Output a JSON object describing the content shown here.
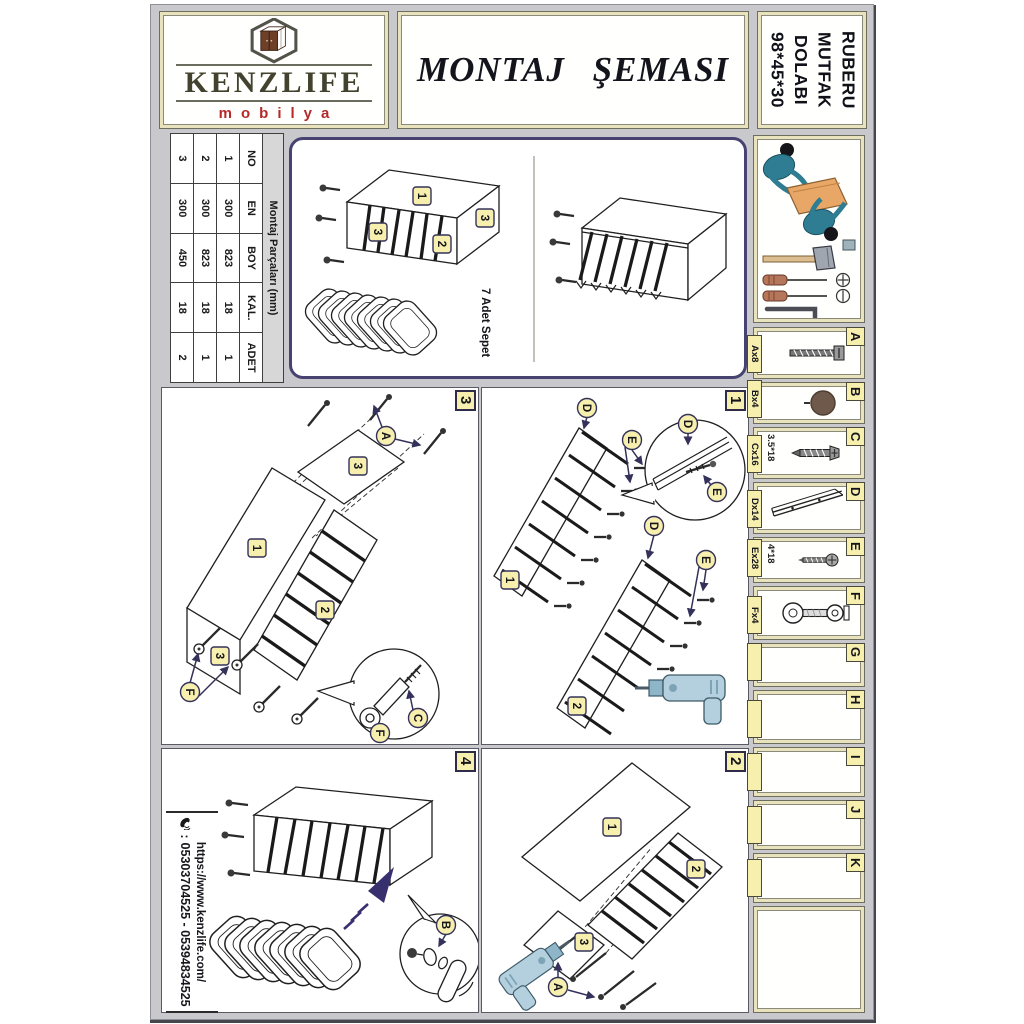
{
  "header": {
    "brand": {
      "name": "KENZLIFE",
      "subtitle": "mobilya",
      "logo_icon": "hexagon-cabinet"
    },
    "title": "MONTAJ ŞEMASI",
    "product": {
      "lines": [
        "RUBERU",
        "MUTFAK",
        "DOLABI",
        "98*45*30"
      ]
    }
  },
  "parts_table": {
    "title": "Montaj Parçaları (mm)",
    "columns": [
      "NO",
      "EN",
      "BOY",
      "KAL.",
      "ADET"
    ],
    "rows": [
      [
        "1",
        "300",
        "823",
        "18",
        "1"
      ],
      [
        "2",
        "300",
        "823",
        "18",
        "1"
      ],
      [
        "3",
        "300",
        "450",
        "18",
        "2"
      ]
    ]
  },
  "overview": {
    "labels": [
      "1",
      "3",
      "2",
      "3"
    ],
    "basket_note": "7 Adet Sepet"
  },
  "hardware": {
    "items": [
      {
        "letter": "A",
        "qty": "Ax8",
        "spec": "",
        "icon": "bolt-screw-icon"
      },
      {
        "letter": "B",
        "qty": "Bx4",
        "spec": "",
        "icon": "cover-cap-icon"
      },
      {
        "letter": "C",
        "qty": "Cx16",
        "spec": "3.5*18",
        "icon": "wood-screw-icon"
      },
      {
        "letter": "D",
        "qty": "Dx14",
        "spec": "",
        "icon": "rail-icon"
      },
      {
        "letter": "E",
        "qty": "Ex28",
        "spec": "4*18",
        "icon": "pan-screw-icon"
      },
      {
        "letter": "F",
        "qty": "Fx4",
        "spec": "",
        "icon": "adjustable-foot-icon"
      },
      {
        "letter": "G",
        "qty": "",
        "spec": "",
        "icon": ""
      },
      {
        "letter": "H",
        "qty": "",
        "spec": "",
        "icon": ""
      },
      {
        "letter": "I",
        "qty": "",
        "spec": "",
        "icon": ""
      },
      {
        "letter": "J",
        "qty": "",
        "spec": "",
        "icon": ""
      },
      {
        "letter": "K",
        "qty": "",
        "spec": "",
        "icon": ""
      }
    ]
  },
  "steps": [
    {
      "number": "1",
      "labels": [
        "D",
        "E",
        "1",
        "D",
        "E",
        "2",
        "D",
        "E"
      ]
    },
    {
      "number": "2",
      "labels": [
        "1",
        "2",
        "3",
        "A"
      ]
    },
    {
      "number": "3",
      "labels": [
        "A",
        "3",
        "1",
        "2",
        "3",
        "F",
        "C",
        "F"
      ]
    },
    {
      "number": "4",
      "labels": [
        "B"
      ]
    }
  ],
  "contact": {
    "website": "https://www.kenzlife.com/",
    "phone_prefix": ":",
    "phones": "05303704525 - 05394834525"
  }
}
